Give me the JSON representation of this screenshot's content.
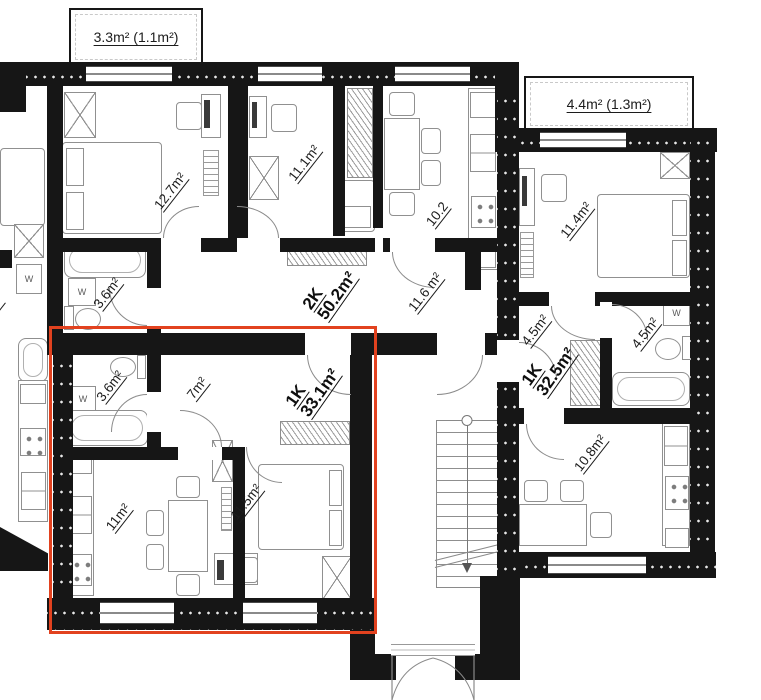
{
  "balconies": {
    "top": "3.3m² (1.1m²)",
    "right": "4.4m² (1.3m²)"
  },
  "apartments": {
    "two_k": {
      "type": "2K",
      "area": "50.2m²"
    },
    "one_k_left": {
      "type": "1K",
      "area": "33.1m²"
    },
    "one_k_right": {
      "type": "1K",
      "area": "32.5m²"
    }
  },
  "rooms": {
    "bedroom_2k": "12.7m²",
    "room_2k": "11.1m²",
    "kitchen_2k": "10.2",
    "corridor_2k": "11.6 m²",
    "bathroom_2k": "3.6m²",
    "bedroom_1k_right": "11.4m²",
    "hall_1k_right": "4.5m²",
    "bathroom_1k_right": "4.5m²",
    "kitchen_1k_right": "10.8m²",
    "bathroom_1k_left": "3.6m²",
    "hall_1k_left": "7m²",
    "kitchen_1k_left": "11m²",
    "bedroom_1k_left": "11.5m²",
    "neighbor_partial": "2m²"
  },
  "fixtures": {
    "washing_machine": "W"
  },
  "colors": {
    "wall": "#161616",
    "highlight": "#e2421f",
    "furniture_line": "#909090"
  }
}
